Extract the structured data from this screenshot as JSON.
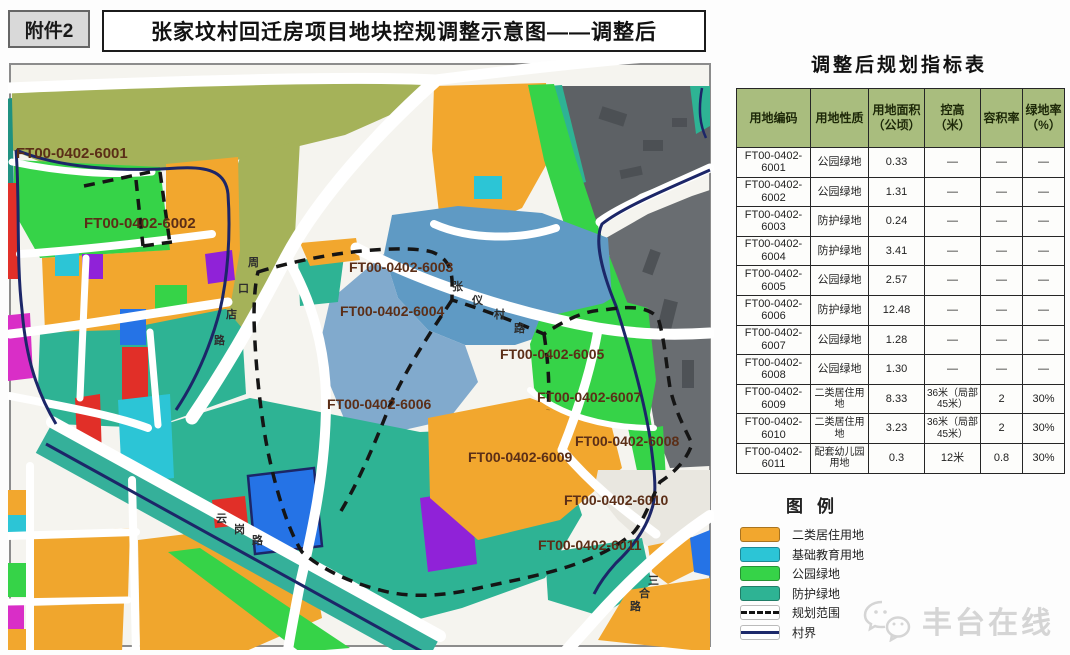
{
  "attachment_label": "附件2",
  "title": "张家坟村回迁房项目地块控规调整示意图——调整后",
  "table": {
    "title": "调整后规划指标表",
    "columns": [
      "用地编码",
      "用地性质",
      "用地面积（公顷）",
      "控高（米）",
      "容积率",
      "绿地率（%）"
    ],
    "rows": [
      {
        "code_prefix": "FT00-0402-",
        "code_suffix": "6001",
        "nature": "公园绿地",
        "area": "0.33",
        "height": "—",
        "far": "—",
        "green": "—"
      },
      {
        "code_prefix": "FT00-0402-",
        "code_suffix": "6002",
        "nature": "公园绿地",
        "area": "1.31",
        "height": "—",
        "far": "—",
        "green": "—"
      },
      {
        "code_prefix": "FT00-0402-",
        "code_suffix": "6003",
        "nature": "防护绿地",
        "area": "0.24",
        "height": "—",
        "far": "—",
        "green": "—"
      },
      {
        "code_prefix": "FT00-0402-",
        "code_suffix": "6004",
        "nature": "防护绿地",
        "area": "3.41",
        "height": "—",
        "far": "—",
        "green": "—"
      },
      {
        "code_prefix": "FT00-0402-",
        "code_suffix": "6005",
        "nature": "公园绿地",
        "area": "2.57",
        "height": "—",
        "far": "—",
        "green": "—"
      },
      {
        "code_prefix": "FT00-0402-",
        "code_suffix": "6006",
        "nature": "防护绿地",
        "area": "12.48",
        "height": "—",
        "far": "—",
        "green": "—"
      },
      {
        "code_prefix": "FT00-0402-",
        "code_suffix": "6007",
        "nature": "公园绿地",
        "area": "1.28",
        "height": "—",
        "far": "—",
        "green": "—"
      },
      {
        "code_prefix": "FT00-0402-",
        "code_suffix": "6008",
        "nature": "公园绿地",
        "area": "1.30",
        "height": "—",
        "far": "—",
        "green": "—"
      },
      {
        "code_prefix": "FT00-0402-",
        "code_suffix": "6009",
        "nature": "二类居住用地",
        "area": "8.33",
        "height": "36米（局部45米）",
        "far": "2",
        "green": "30%"
      },
      {
        "code_prefix": "FT00-0402-",
        "code_suffix": "6010",
        "nature": "二类居住用地",
        "area": "3.23",
        "height": "36米（局部45米）",
        "far": "2",
        "green": "30%"
      },
      {
        "code_prefix": "FT00-0402-",
        "code_suffix": "6011",
        "nature": "配套幼儿园用地",
        "area": "0.3",
        "height": "12米",
        "far": "0.8",
        "green": "30%"
      }
    ]
  },
  "legend": {
    "title": "图例",
    "items": [
      {
        "label": "二类居住用地",
        "swatch": "fill",
        "color": "#f2a72e"
      },
      {
        "label": "基础教育用地",
        "swatch": "fill",
        "color": "#2cc5d6"
      },
      {
        "label": "公园绿地",
        "swatch": "fill",
        "color": "#36d348"
      },
      {
        "label": "防护绿地",
        "swatch": "fill",
        "color": "#2eb394"
      },
      {
        "label": "规划范围",
        "swatch": "dashed-line",
        "color": "#141414"
      },
      {
        "label": "村界",
        "swatch": "solid-line",
        "color": "#1d2a6b"
      }
    ]
  },
  "map": {
    "parcel_labels": [
      "FT00-0402-6001",
      "FT00-0402-6002",
      "FT00-0402-6003",
      "FT00-0402-6004",
      "FT00-0402-6005",
      "FT00-0402-6006",
      "FT00-0402-6007",
      "FT00-0402-6008",
      "FT00-0402-6009",
      "FT00-0402-6010",
      "FT00-0402-6011"
    ],
    "road_labels": [
      "周口店路",
      "张仪村路",
      "云岗路",
      "三合路"
    ]
  },
  "watermark": {
    "text": "丰台在线",
    "icon": "wechat-logo"
  },
  "colors": {
    "residential_orange": "#f2a72e",
    "education_cyan": "#2cc5d6",
    "park_green": "#36d348",
    "buffer_teal": "#2eb394",
    "village_olive": "#a5b259",
    "builtup_gray": "#5d6165",
    "water_blue": "#5f9ac4",
    "plot_blue": "#2573e6",
    "plot_purple": "#9022d8",
    "plot_magenta": "#d92ec7",
    "plot_red": "#e12f28",
    "boundary_navy": "#1c2668",
    "plan_dash_black": "#151515",
    "table_header_green": "#a9bd7e",
    "label_brown": "#5b2e17"
  }
}
